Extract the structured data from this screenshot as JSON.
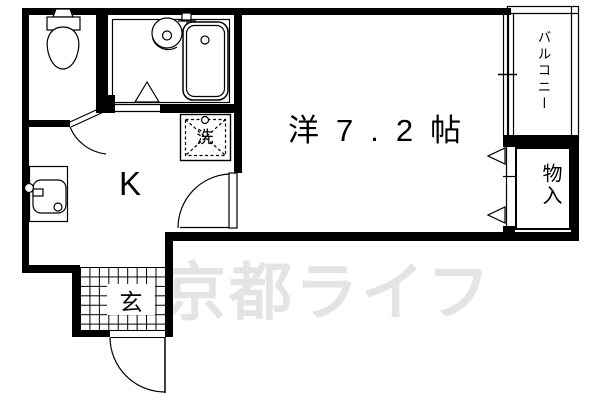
{
  "floorplan": {
    "rooms": {
      "main_room": {
        "label": "洋7.2帖"
      },
      "kitchen": {
        "label": "K"
      },
      "entrance": {
        "label": "玄"
      },
      "balcony": {
        "label": "バルコニー"
      },
      "storage": {
        "label": "物入"
      },
      "laundry": {
        "label": "洗"
      }
    },
    "watermark": {
      "text": "京都ライフ",
      "color": "#e4e4e4"
    },
    "colors": {
      "wall": "#000000",
      "background": "#ffffff"
    },
    "icons": [
      "toilet-icon",
      "bathtub-icon",
      "bath-sink-icon",
      "bath-faucet-icon",
      "washing-machine-icon",
      "kitchen-sink-icon",
      "door-swing-arc",
      "sliding-window-icon",
      "closet-door-triangle-icon",
      "entrance-checker-floor"
    ]
  }
}
